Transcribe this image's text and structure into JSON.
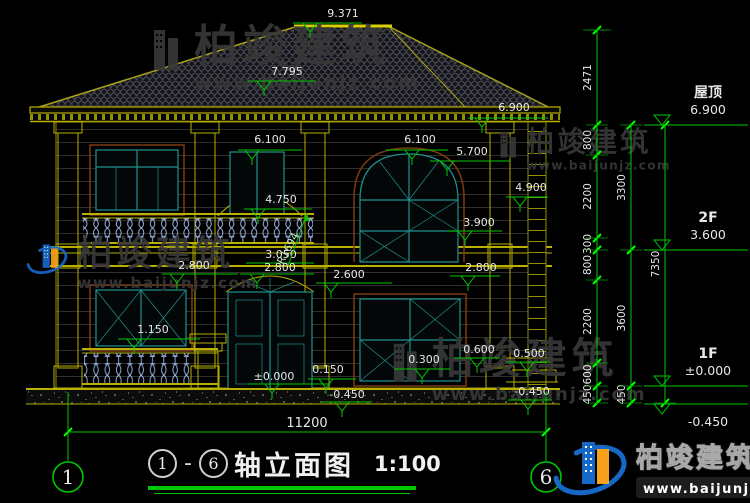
{
  "colors": {
    "background": "#000000",
    "dim_green": "#00c800",
    "tick_green": "#00ff00",
    "building_yellow": "#b9b000",
    "ridge_yellow": "#d8d000",
    "window_teal": "#22918f",
    "trim_brown": "#7a3a12",
    "baluster_blue": "#9ab4e4",
    "roof_tile_line": "#50505c",
    "text_white": "#e8e8e8",
    "watermark_gray": "#383838",
    "logo_blue": "#1668c7",
    "logo_orange": "#f6a21c"
  },
  "title_block": {
    "axis_from": "1",
    "separator": "-",
    "axis_to": "6",
    "name": "轴立面图",
    "scale": "1:100"
  },
  "brand": {
    "name": "柏竣建筑",
    "url": "www.baijunjz.com"
  },
  "drawing": {
    "markers": [
      {
        "label": "9.371",
        "x1": 293,
        "x2": 362,
        "y": 23,
        "tri": 310,
        "tx": 343,
        "ty": 17
      },
      {
        "label": "7.795",
        "x1": 248,
        "x2": 316,
        "y": 81,
        "tri": 264,
        "tx": 287,
        "ty": 75
      },
      {
        "label": "6.900",
        "x1": 468,
        "x2": 548,
        "y": 118,
        "tri": 482,
        "tx": 514,
        "ty": 111
      },
      {
        "label": "6.100",
        "x1": 238,
        "x2": 302,
        "y": 150,
        "tri": 252,
        "tx": 270,
        "ty": 143
      },
      {
        "label": "6.100",
        "x1": 386,
        "x2": 448,
        "y": 150,
        "tri": 412,
        "tx": 420,
        "ty": 143
      },
      {
        "label": "5.700",
        "x1": 430,
        "x2": 510,
        "y": 161,
        "tri": 447,
        "tx": 472,
        "ty": 155
      },
      {
        "label": "4.900",
        "x1": 506,
        "x2": 548,
        "y": 197,
        "tri": 520,
        "tx": 531,
        "ty": 191
      },
      {
        "label": "4.750",
        "x1": 244,
        "x2": 312,
        "y": 209,
        "tri": 258,
        "tx": 281,
        "ty": 203
      },
      {
        "label": "3.900",
        "x1": 448,
        "x2": 502,
        "y": 231,
        "tri": 465,
        "tx": 479,
        "ty": 226
      },
      {
        "label": "3.050",
        "x1": 246,
        "x2": 314,
        "y": 263,
        "tri": null,
        "tx": 281,
        "ty": 258
      },
      {
        "label": "2.800",
        "x1": 240,
        "x2": 314,
        "y": 274,
        "tri": 257,
        "tx": 280,
        "ty": 271
      },
      {
        "label": "2.800",
        "x1": 162,
        "x2": 238,
        "y": 274,
        "tri": 177,
        "tx": 194,
        "ty": 269
      },
      {
        "label": "2.600",
        "x1": 316,
        "x2": 392,
        "y": 283,
        "tri": 331,
        "tx": 349,
        "ty": 278
      },
      {
        "label": "2.800",
        "x1": 450,
        "x2": 500,
        "y": 276,
        "tri": 468,
        "tx": 481,
        "ty": 271
      },
      {
        "label": "1.150",
        "x1": 118,
        "x2": 200,
        "y": 339,
        "tri": 134,
        "tx": 153,
        "ty": 333
      },
      {
        "label": "±0.000",
        "x1": 248,
        "x2": 330,
        "y": 384,
        "tri": 272,
        "tx": 274,
        "ty": 380
      },
      {
        "label": "0.150",
        "x1": 308,
        "x2": 356,
        "y": 379,
        "tri": 326,
        "tx": 328,
        "ty": 373
      },
      {
        "label": "0.300",
        "x1": 394,
        "x2": 450,
        "y": 369,
        "tri": 422,
        "tx": 424,
        "ty": 363
      },
      {
        "label": "0.600",
        "x1": 454,
        "x2": 500,
        "y": 358,
        "tri": 477,
        "tx": 479,
        "ty": 353
      },
      {
        "label": "0.500",
        "x1": 506,
        "x2": 550,
        "y": 362,
        "tri": 527,
        "tx": 529,
        "ty": 357
      },
      {
        "label": "-0.450",
        "x1": 322,
        "x2": 372,
        "y": 402,
        "tri": 342,
        "tx": 347,
        "ty": 398
      },
      {
        "label": "-0.450",
        "x1": 508,
        "x2": 552,
        "y": 400,
        "tri": 528,
        "tx": 532,
        "ty": 395
      }
    ],
    "radius_label": {
      "label": "R1694",
      "x": 291,
      "y": 250,
      "rotation": -62,
      "leader": {
        "x1": 288,
        "y1": 266,
        "x2": 307,
        "y2": 213
      }
    },
    "overall_dim": {
      "label": "11200",
      "x1": 68,
      "x2": 546,
      "y": 432,
      "tx": 307,
      "ty": 427
    },
    "axes": [
      {
        "label": "1",
        "x": 68,
        "cy": 477,
        "line_top": 392
      },
      {
        "label": "6",
        "x": 546,
        "cy": 477,
        "line_top": 392
      }
    ]
  },
  "right_panel": {
    "chains": [
      {
        "x": 597,
        "segments": [
          {
            "label": "2471",
            "y1": 30,
            "y2": 125
          },
          {
            "label": "800",
            "y1": 125,
            "y2": 155
          },
          {
            "label": "2200",
            "y1": 155,
            "y2": 238
          },
          {
            "label": "300",
            "y1": 238,
            "y2": 250
          },
          {
            "label": "800",
            "y1": 250,
            "y2": 280
          },
          {
            "label": "2200",
            "y1": 280,
            "y2": 363
          },
          {
            "label": "600",
            "y1": 363,
            "y2": 386
          },
          {
            "label": "450",
            "y1": 386,
            "y2": 403
          }
        ]
      },
      {
        "x": 631,
        "segments": [
          {
            "label": "3300",
            "y1": 125,
            "y2": 250
          },
          {
            "label": "3600",
            "y1": 250,
            "y2": 386
          },
          {
            "label": "450",
            "y1": 386,
            "y2": 403
          }
        ]
      },
      {
        "x": 665,
        "segments": [
          {
            "label": "7350",
            "y1": 125,
            "y2": 403
          }
        ]
      }
    ],
    "levels": [
      {
        "name": "屋顶",
        "value": "6.900",
        "y": 125,
        "flip": false
      },
      {
        "name": "2F",
        "value": "3.600",
        "y": 250,
        "flip": false
      },
      {
        "name": "1F",
        "value": "±0.000",
        "y": 386,
        "flip": false
      },
      {
        "name": "",
        "value": "-0.450",
        "y": 404,
        "flip": true
      }
    ]
  },
  "watermarks": [
    {
      "x": 150,
      "y": 24,
      "scale": 1.0,
      "colored": false
    },
    {
      "x": 498,
      "y": 128,
      "scale": 0.64,
      "colored": false
    },
    {
      "x": 26,
      "y": 236,
      "scale": 0.8,
      "colored": true
    },
    {
      "x": 390,
      "y": 338,
      "scale": 0.95,
      "colored": false
    }
  ]
}
